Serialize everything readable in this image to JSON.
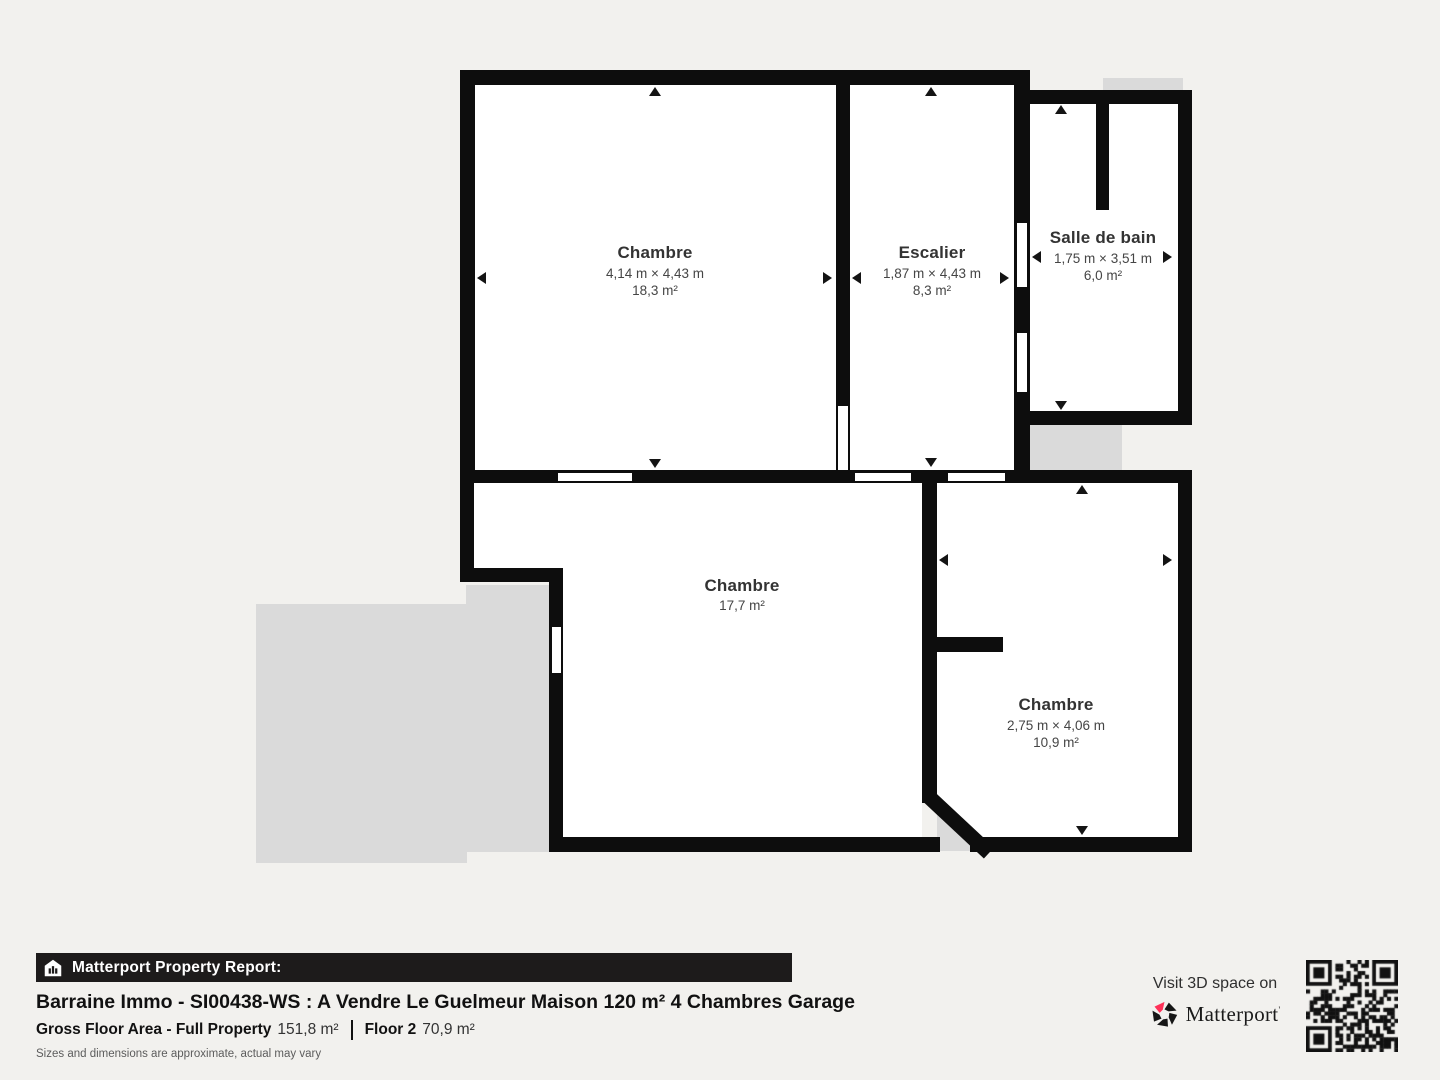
{
  "colors": {
    "background": "#f2f1ee",
    "wall": "#0d0d0d",
    "room_fill": "#ffffff",
    "shadow": "#dadada",
    "label_text": "#3c3c3c",
    "banner_bg": "#1d1b1b",
    "brand_red": "#ff3158"
  },
  "floorplan": {
    "rooms": [
      {
        "id": "chambre-1",
        "name": "Chambre",
        "dimensions": "4,14 m × 4,43 m",
        "area": "18,3 m²"
      },
      {
        "id": "escalier",
        "name": "Escalier",
        "dimensions": "1,87 m × 4,43 m",
        "area": "8,3 m²"
      },
      {
        "id": "salle-de-bain",
        "name": "Salle de bain",
        "dimensions": "1,75 m × 3,51 m",
        "area": "6,0 m²"
      },
      {
        "id": "chambre-2",
        "name": "Chambre",
        "area": "17,7 m²"
      },
      {
        "id": "chambre-3",
        "name": "Chambre",
        "dimensions": "2,75 m × 4,06 m",
        "area": "10,9 m²"
      }
    ]
  },
  "footer": {
    "report_label": "Matterport Property Report:",
    "title": "Barraine Immo - SI00438-WS : A Vendre Le Guelmeur Maison 120 m² 4 Chambres Garage",
    "gross_label": "Gross Floor Area - Full Property",
    "gross_value": "151,8 m²",
    "floor_label": "Floor 2",
    "floor_value": "70,9 m²",
    "disclaimer": "Sizes and dimensions are approximate, actual may vary",
    "visit_label": "Visit 3D space on",
    "brand": "Matterport",
    "brand_mark": "'"
  }
}
